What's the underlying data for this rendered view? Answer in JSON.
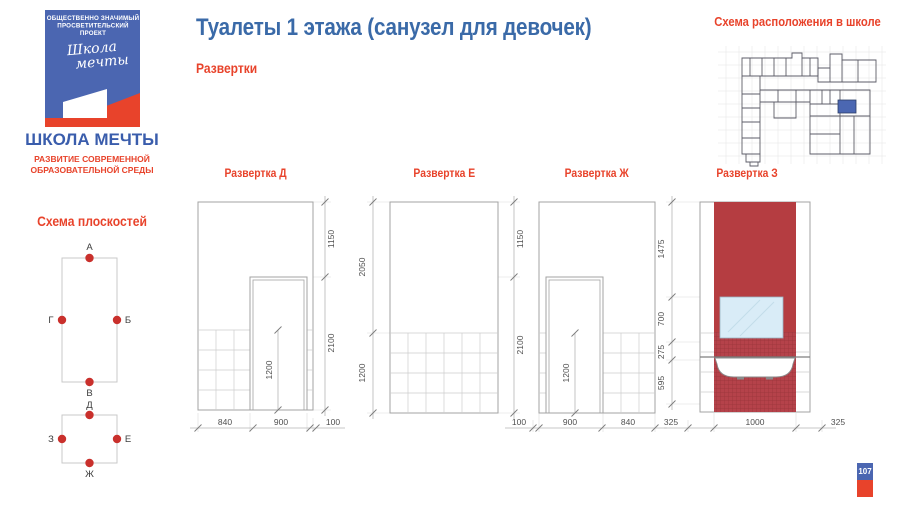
{
  "header": {
    "title": "Туалеты 1 этажа (санузел для девочек)",
    "subtitle": "Развертки"
  },
  "logo": {
    "tag_line1": "ОБЩЕСТВЕННО ЗНАЧИМЫЙ",
    "tag_line2": "ПРОСВЕТИТЕЛЬСКИЙ ПРОЕКТ",
    "script_line1": "Школа",
    "script_line2": "мечты",
    "name": "ШКОЛА МЕЧТЫ",
    "subtitle_line1": "РАЗВИТИЕ СОВРЕМЕННОЙ",
    "subtitle_line2": "ОБРАЗОВАТЕЛЬНОЙ СРЕДЫ"
  },
  "school_map": {
    "title": "Схема расположения в школе",
    "highlight_color": "#4b67b2"
  },
  "plane_scheme": {
    "title": "Схема плоскостей",
    "rect1_points": [
      "А",
      "Б",
      "В",
      "Г"
    ],
    "rect2_points": [
      "Д",
      "Е",
      "Ж",
      "З"
    ]
  },
  "elevations": [
    {
      "title": "Развертка Д",
      "dims_right": [
        "1150",
        "2100"
      ],
      "door_dim": "1200",
      "dims_bottom": [
        "840",
        "900",
        "100"
      ]
    },
    {
      "title": "Развертка Е",
      "dims_left": [
        "2050",
        "1200"
      ],
      "dims_right": [
        "1150",
        "2100"
      ]
    },
    {
      "title": "Развертка Ж",
      "door_dim": "1200",
      "dims_bottom": [
        "100",
        "900",
        "840"
      ]
    },
    {
      "title": "Развертка З",
      "dims_left": [
        "1475",
        "700",
        "275",
        "595"
      ],
      "dims_bottom": [
        "325",
        "1000",
        "325"
      ],
      "wall_color": "#b53d41",
      "mirror_color": "#d9ecf7"
    }
  ],
  "page": {
    "number": "107"
  },
  "colors": {
    "accent_red": "#e8432b",
    "heading_blue": "#3a6aa8",
    "logo_blue": "#4b66b1",
    "tile_red": "#b53d41",
    "mirror_blue": "#d9ecf7",
    "plan_highlight": "#4b67b2"
  }
}
